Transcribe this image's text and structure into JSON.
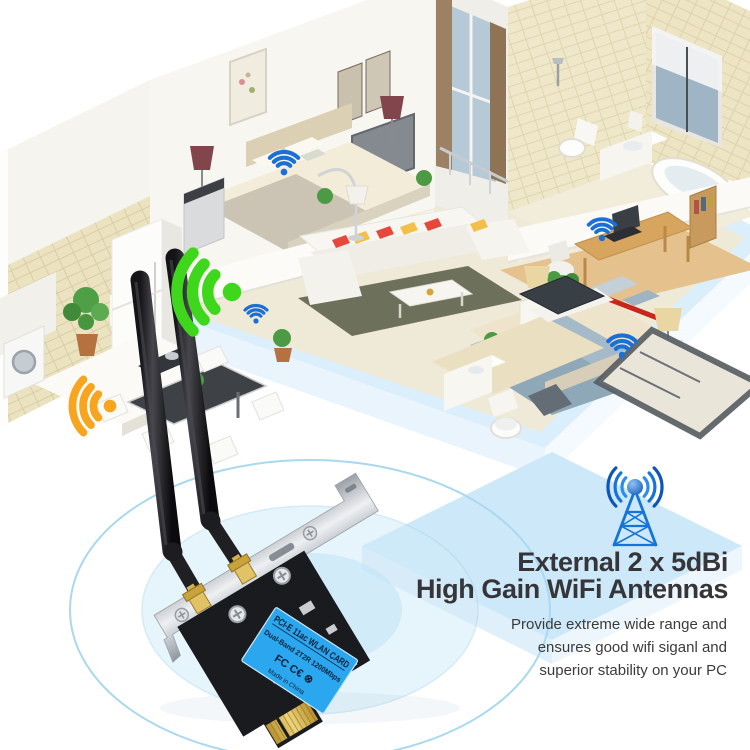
{
  "headline": {
    "line1": "External 2 x 5dBi",
    "line2": "High Gain WiFi Antennas"
  },
  "body": {
    "line1": "Provide extreme wide range and",
    "line2": "ensures good wifi siganl and",
    "line3": "superior stability on your PC"
  },
  "card_label": {
    "line1": "PCI-E 11ac WLAN CARD",
    "line2": "Dual-Band 2T2R 1200Mbps",
    "certs": "FC  C€  ⊗",
    "line4": "Made in China"
  },
  "colors": {
    "wifi_blue": "#1c6fd4",
    "wifi_green": "#3fd71c",
    "wifi_orange": "#f7a41f",
    "tower_blue": "#1673da",
    "label_blue": "#2ba7ef",
    "base_blue": "#dbeefb",
    "headline_text": "#36363a"
  },
  "wifi_markers": [
    {
      "name": "bedroom-upper",
      "color": "wifi_blue",
      "x": 284,
      "y": 172,
      "scale": 0.8,
      "rotate": 0
    },
    {
      "name": "living-room",
      "color": "wifi_blue",
      "x": 256,
      "y": 321,
      "scale": 0.62,
      "rotate": 0
    },
    {
      "name": "study",
      "color": "wifi_blue",
      "x": 602,
      "y": 238,
      "scale": 0.75,
      "rotate": 0
    },
    {
      "name": "master-bedroom",
      "color": "wifi_blue",
      "x": 622,
      "y": 355,
      "scale": 0.78,
      "rotate": 0
    },
    {
      "name": "living-room-beam",
      "color": "wifi_green",
      "x": 232,
      "y": 292,
      "scale": 2.2,
      "rotate": -90
    },
    {
      "name": "dining-beam",
      "color": "wifi_orange",
      "x": 110,
      "y": 406,
      "scale": 1.5,
      "rotate": -90
    }
  ]
}
